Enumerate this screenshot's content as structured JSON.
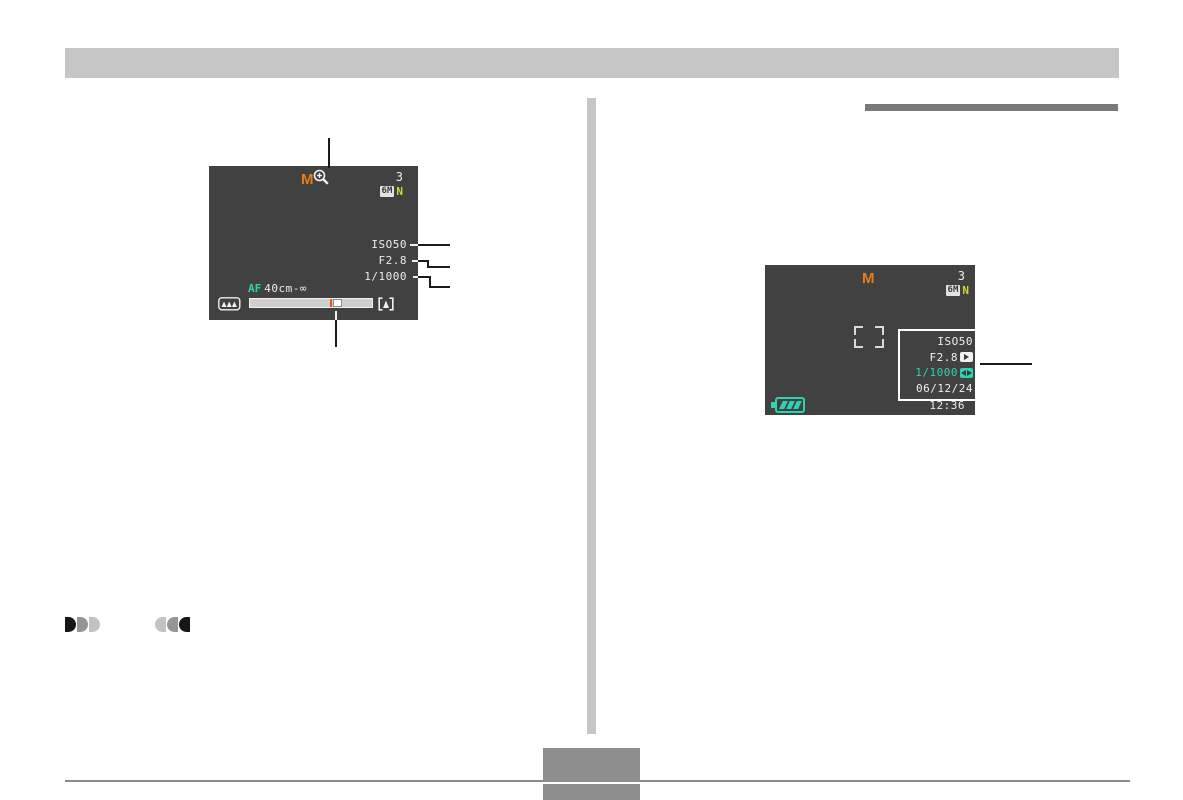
{
  "left_lcd": {
    "mode_indicator": "M",
    "remaining_shots": "3",
    "image_size_badge": "6M",
    "quality_indicator": "N",
    "iso_value": "ISO50",
    "aperture_value": "F2.8",
    "shutter_value": "1/1000",
    "af_label": "AF",
    "focus_range": "40cm-∞"
  },
  "right_lcd": {
    "mode_indicator": "M",
    "remaining_shots": "3",
    "image_size_badge": "6M",
    "quality_indicator": "N",
    "settings_panel": {
      "iso_value": "ISO50",
      "aperture_value": "F2.8",
      "shutter_value": "1/1000",
      "date_value": "06/12/24"
    },
    "time_value": "12:36"
  },
  "colors": {
    "lcd_background": "#414141",
    "mode_orange": "#e87c1c",
    "quality_yellow": "#d6d62e",
    "teal_accent": "#2fd2b0",
    "lcd_text": "#ececec",
    "header_gray": "#c6c6c6",
    "heading_bar_gray": "#7a7a7a",
    "pagenum_gray": "#8e8e8e"
  }
}
